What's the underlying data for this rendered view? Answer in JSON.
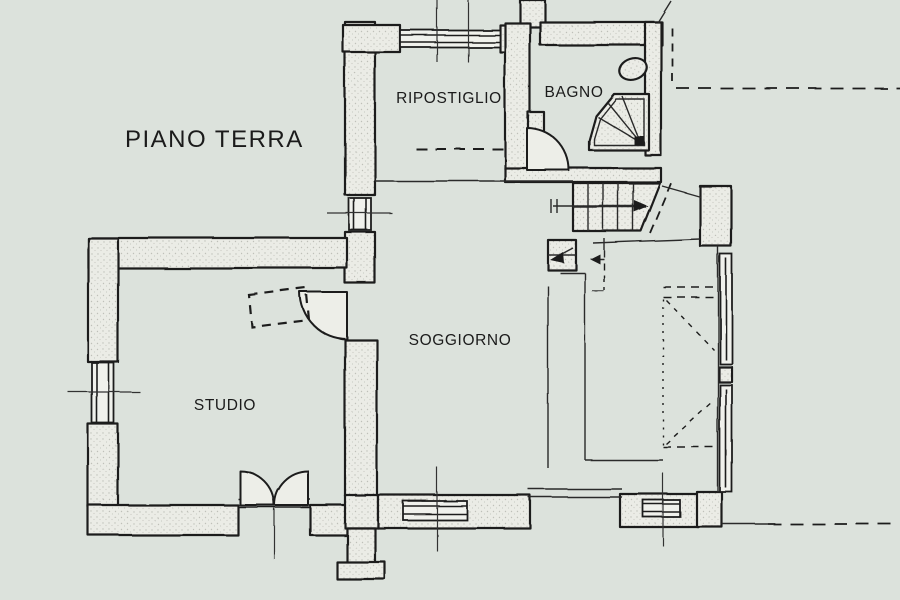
{
  "title": "PIANO TERRA",
  "rooms": {
    "ripostiglio": "RIPOSTIGLIO",
    "bagno": "BAGNO",
    "soggiorno": "SOGGIORNO",
    "studio": "STUDIO"
  },
  "fixtures": [
    "stairs-up",
    "toilet",
    "corner-shower",
    "hinged-door",
    "double-door",
    "window",
    "sliding-glass-wall",
    "dashed-property-line",
    "dashed-opening",
    "dashed-furniture-outline"
  ],
  "colors": {
    "background": "#dce2dc",
    "line": "#1e1e1e",
    "wall_fill": "#ebece6",
    "window_fill": "#f0f1ec",
    "text": "#1b1b1b"
  }
}
